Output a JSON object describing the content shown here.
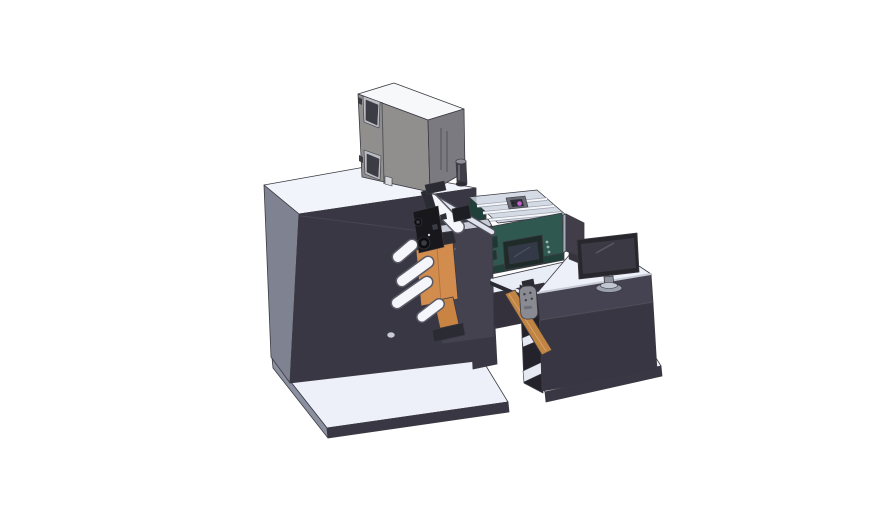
{
  "scene": {
    "background": "#ffffff",
    "description": "Isometric CAD render of a label printing machine line: large dark cabinet with a gray hopper box on top, unwind station with orange label rolls and white guide rollers, black print-head mechanism, teal inkjet unit with clear cover and HMI touchscreen, output chute feeding an operator desk with a monitor; machine and desk each stand on a light base platform."
  },
  "components": {
    "machine_platform": "machine base platform",
    "cabinet": "main machine cabinet",
    "hopper_box": "top-mounted hopper box",
    "unwind_station": "unwind rollers and label rolls",
    "print_head": "print-head mechanism",
    "tower": "center support tower",
    "inkjet_unit": "teal inkjet unit with clear cover",
    "hmi": "HMI touchscreen panel",
    "conveyor": "output conveyor",
    "chute": "output chute",
    "pendant": "hand-held control pendant",
    "desk": "operator desk with shelves",
    "desk_platform": "desk base platform",
    "monitor": "desktop monitor",
    "divider_panel": "rear divider panel"
  },
  "colors": {
    "outline": "#3b3a42",
    "platform_top": "#edf0f8",
    "platform_side": "#8b90a1",
    "dark_panel": "#3a3744",
    "cabinet_top": "#f2f4fb",
    "cabinet_side": "#7f8391",
    "crease": "#4a4755",
    "hole_light": "#c9ccd6",
    "box_top": "#f7f8fa",
    "box_front": "#908f8e",
    "box_side": "#7b7a80",
    "box_window": "#3c3c44",
    "box_window_frame": "#b9bcc2",
    "box_seam": "#55545a",
    "vent": "#606066",
    "foot_square": "#d8d9dd",
    "hinge": "#3a3a40",
    "knob": "#3f3e46",
    "knob_cap": "#8f8f97",
    "knob_base": "#2e2d34",
    "deck_top": "#e9edf6",
    "under_beam": "#34313d",
    "tower_front": "#454250",
    "tower_top": "#c8ccd7",
    "tower_dot": "#5d5a68",
    "roller_white": "#f4f6fb",
    "roller_outline": "#5a5a64",
    "rail_light": "#dfe3ee",
    "rail_dark": "#50505a",
    "orange_roll": "#d28c4e",
    "orange_roll_dark": "#c98443",
    "orange_line": "#b4743c",
    "chute_tan": "#c08443",
    "chute_highlight": "#d9a268",
    "mech_black": "#17171c",
    "mech_gray": "#2b2b33",
    "mech_mid": "#1d1d24",
    "mech_hub": "#0e0e12",
    "mech_hub_inner": "#3c3c46",
    "teal_body": "#2f5850",
    "teal_dark": "#22403a",
    "teal_slot": "#1c3832",
    "teal_button": "#9fb3ac",
    "hmi_bezel": "#1e2b28",
    "hmi_screen": "#343947",
    "hmi_glint": "#4c515f",
    "cover_glass": "#ccd3df",
    "rail_white": "#f4f6fa",
    "rail_under": "#9aa0ad",
    "carriage_gray": "#6a6a74",
    "carriage_dark": "#2e2e36",
    "magenta_accent": "#c75fd0",
    "conveyor_dark": "#2a2a32",
    "conveyor_light": "#e8ebf3",
    "desk_top": "#edf0f8",
    "desk_slab_edge": "#c7cbd6",
    "desk_front_upper": "#454251",
    "desk_front_lower": "#393643",
    "desk_seam": "#504d5a",
    "desk_interior": "#24222b",
    "shelf_white": "#e6e9f2",
    "pendant_gray": "#8a8a92",
    "pendant_dot": "#3e3e46",
    "pendant_slot": "#6e6e76",
    "pendant_bracket": "#2c2b33",
    "panel_gray": "#413e49",
    "panel_edge": "#a6abb8",
    "panel_foot": "#35333c",
    "monitor_bezel": "#28272d",
    "monitor_screen": "#3b3a44",
    "monitor_glint": "#5a5966",
    "stand_gray": "#9aa0ad",
    "stand_top": "#c2c7d2",
    "neck_gray": "#8f94a1"
  }
}
